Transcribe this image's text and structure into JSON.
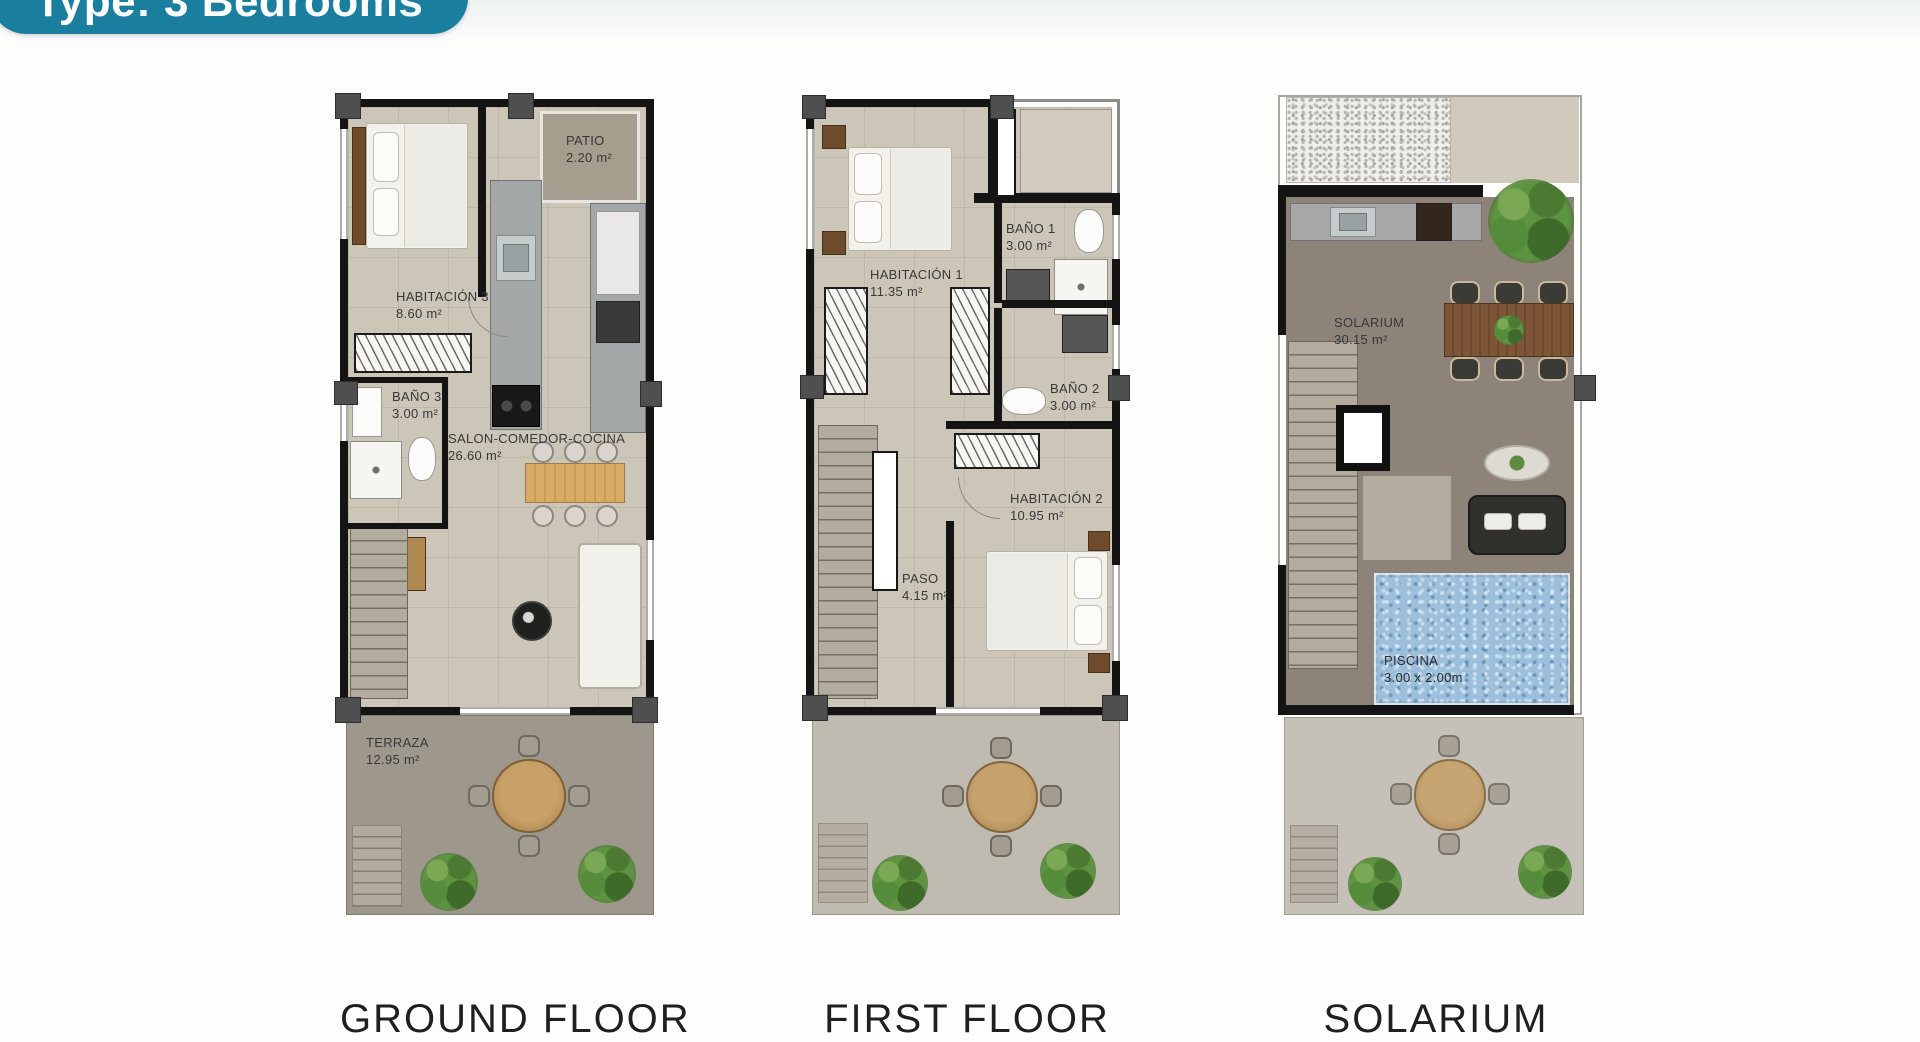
{
  "badge": {
    "label": "Type: 3 Bedrooms"
  },
  "palette": {
    "accent_teal": "#1a7e9e",
    "pool_blue": "#9cc0dc",
    "wall_black": "#141414",
    "floor_beige": "#ccc6b9",
    "deck_taupe": "#8d8379"
  },
  "plans": [
    {
      "caption": "GROUND FLOOR",
      "rooms": [
        {
          "name": "HABITACIÓN 3",
          "area": "8.60 m²"
        },
        {
          "name": "PATIO",
          "area": "2.20 m²"
        },
        {
          "name": "BAÑO 3",
          "area": "3.00 m²"
        },
        {
          "name": "SALON-COMEDOR-COCINA",
          "area": "26.60 m²"
        },
        {
          "name": "TERRAZA",
          "area": "12.95 m²"
        }
      ]
    },
    {
      "caption": "FIRST FLOOR",
      "rooms": [
        {
          "name": "HABITACIÓN 1",
          "area": "11.35 m²"
        },
        {
          "name": "BAÑO 1",
          "area": "3.00 m²"
        },
        {
          "name": "BAÑO 2",
          "area": "3.00 m²"
        },
        {
          "name": "HABITACIÓN 2",
          "area": "10.95 m²"
        },
        {
          "name": "PASO",
          "area": "4.15 m²"
        }
      ]
    },
    {
      "caption": "SOLARIUM",
      "rooms": [
        {
          "name": "SOLARIUM",
          "area": "30.15 m²"
        },
        {
          "name": "PISCINA",
          "area": "3.00 x 2.00m"
        }
      ]
    }
  ]
}
